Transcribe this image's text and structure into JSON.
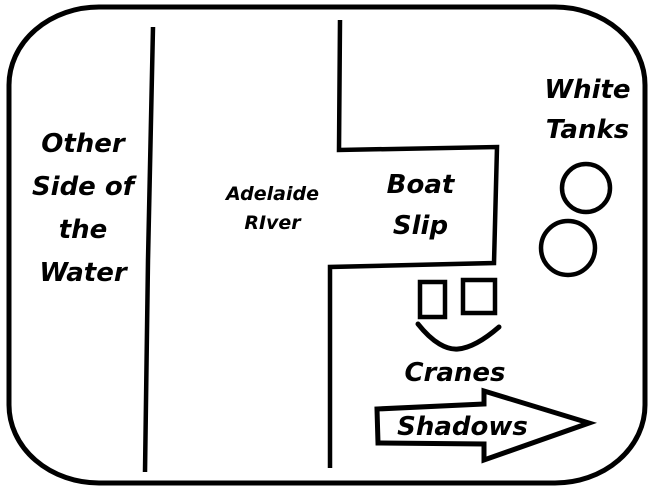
{
  "canvas": {
    "background": "#ffffff",
    "ink": "#000000"
  },
  "labels": {
    "other_side": [
      "Other",
      "Side of",
      "the",
      "Water"
    ],
    "river": [
      "Adelaide",
      "RIver"
    ],
    "boat_slip": [
      "Boat",
      "Slip"
    ],
    "white_tanks": [
      "White",
      "Tanks"
    ],
    "cranes": "Cranes",
    "shadows": "Shadows"
  },
  "shapes": {
    "outer_border": "rounded-rectangle-outline",
    "left_divider": "vertical-line",
    "river_bank": "polyline-with-boat-slip-notch",
    "tank_circles": 2,
    "crane_squares": 2,
    "crane_pointer": "curved-check-mark",
    "shadows_arrow": "right-block-arrow"
  }
}
